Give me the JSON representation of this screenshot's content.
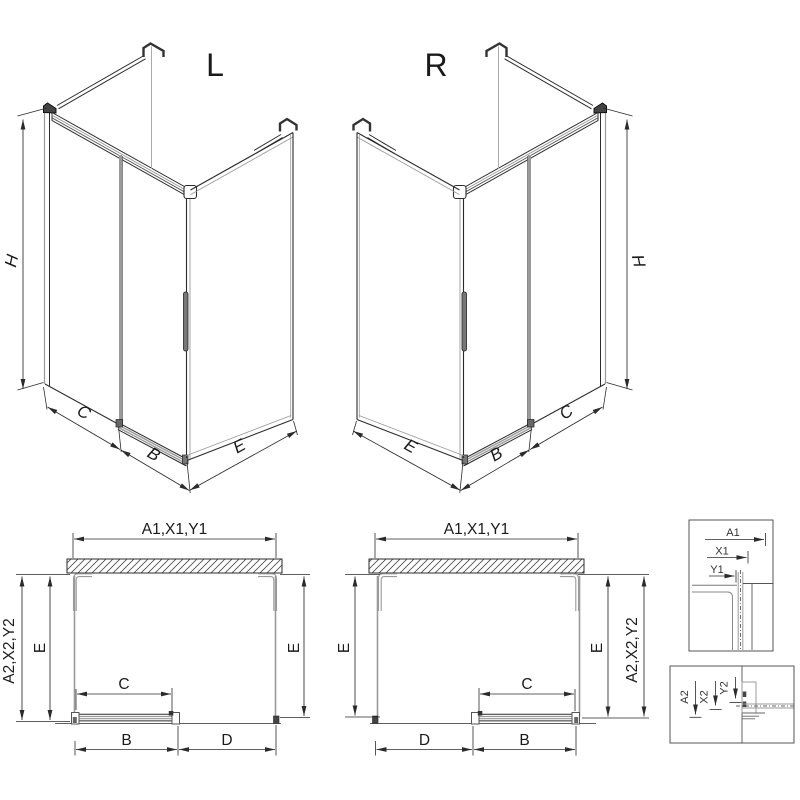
{
  "iso_left": {
    "title": "L",
    "h": "H",
    "c": "C",
    "b": "B",
    "e": "E"
  },
  "iso_right": {
    "title": "R",
    "h": "H",
    "c": "C",
    "b": "B",
    "e": "E"
  },
  "plan_left": {
    "width_top": "A1,X1,Y1",
    "height_left": "A2,X2,Y2",
    "e_left": "E",
    "e_right": "E",
    "c": "C",
    "b": "B",
    "d": "D"
  },
  "plan_right": {
    "width_top": "A1,X1,Y1",
    "height_right": "A2,X2,Y2",
    "e_left": "E",
    "e_right": "E",
    "c": "C",
    "b": "B",
    "d": "D"
  },
  "detail_top": {
    "a1": "A1",
    "x1": "X1",
    "y1": "Y1"
  },
  "detail_bottom": {
    "a2": "A2",
    "x2": "X2",
    "y2": "Y2"
  },
  "colors": {
    "line": "#2b2b2b",
    "glass": "#9a9a9a",
    "text": "#1a1a1a",
    "background": "#ffffff"
  }
}
